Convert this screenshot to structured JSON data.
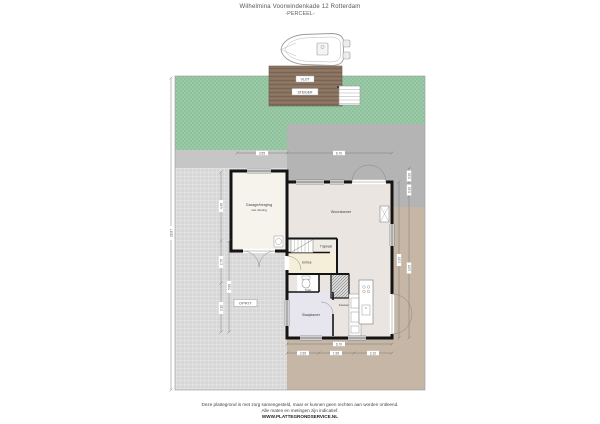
{
  "header": {
    "title": "Wilhelmina Voorwindenkade 12 Rotterdam",
    "subtitle": "-PERCEEL-"
  },
  "labels": {
    "deck_top": "VLOT",
    "deck_bottom": "STEIGER",
    "driveway": "OPRIT",
    "garage_1": "Garage/berging",
    "garage_2": "met vliering",
    "living": "Woonkamer",
    "kitchen": "Keuken",
    "bedroom": "Slaapkamer",
    "hall": "Entree",
    "toilet": "Toilet",
    "stairs": "Trapkast"
  },
  "dims": {
    "top_left": "3.55",
    "top_right": "6.70",
    "bottom_total": "6.70",
    "bottom_1": "2.65",
    "bottom_2": "1.95",
    "bottom_3": "2.10",
    "left_total": "28.87",
    "left_1": "4.40",
    "left_2": "2.70",
    "left_3": "3.10",
    "left_inner": "5.80",
    "right_total": "9.95",
    "right_1": "0.90",
    "right_2": "0.90",
    "right_3": "9.05"
  },
  "colors": {
    "lawn": "#8fc29c",
    "tiles": "#d7d7d7",
    "terrace": "#c5b6a6",
    "patio": "#b4b4b4",
    "deck": "#8a7260",
    "wall": "#141414",
    "floor_living": "#eae5e1",
    "floor_bedroom": "#e7e5ed",
    "floor_hall": "#f5efd9"
  },
  "footer": {
    "line1": "Deze plattegrond is met zorg samengesteld, maar er kunnen geen rechten aan worden ontleend.",
    "line2": "Alle maten en metingen zijn indicatief.",
    "line3": "WWW.PLATTEGRONDSERVICE.NL"
  }
}
